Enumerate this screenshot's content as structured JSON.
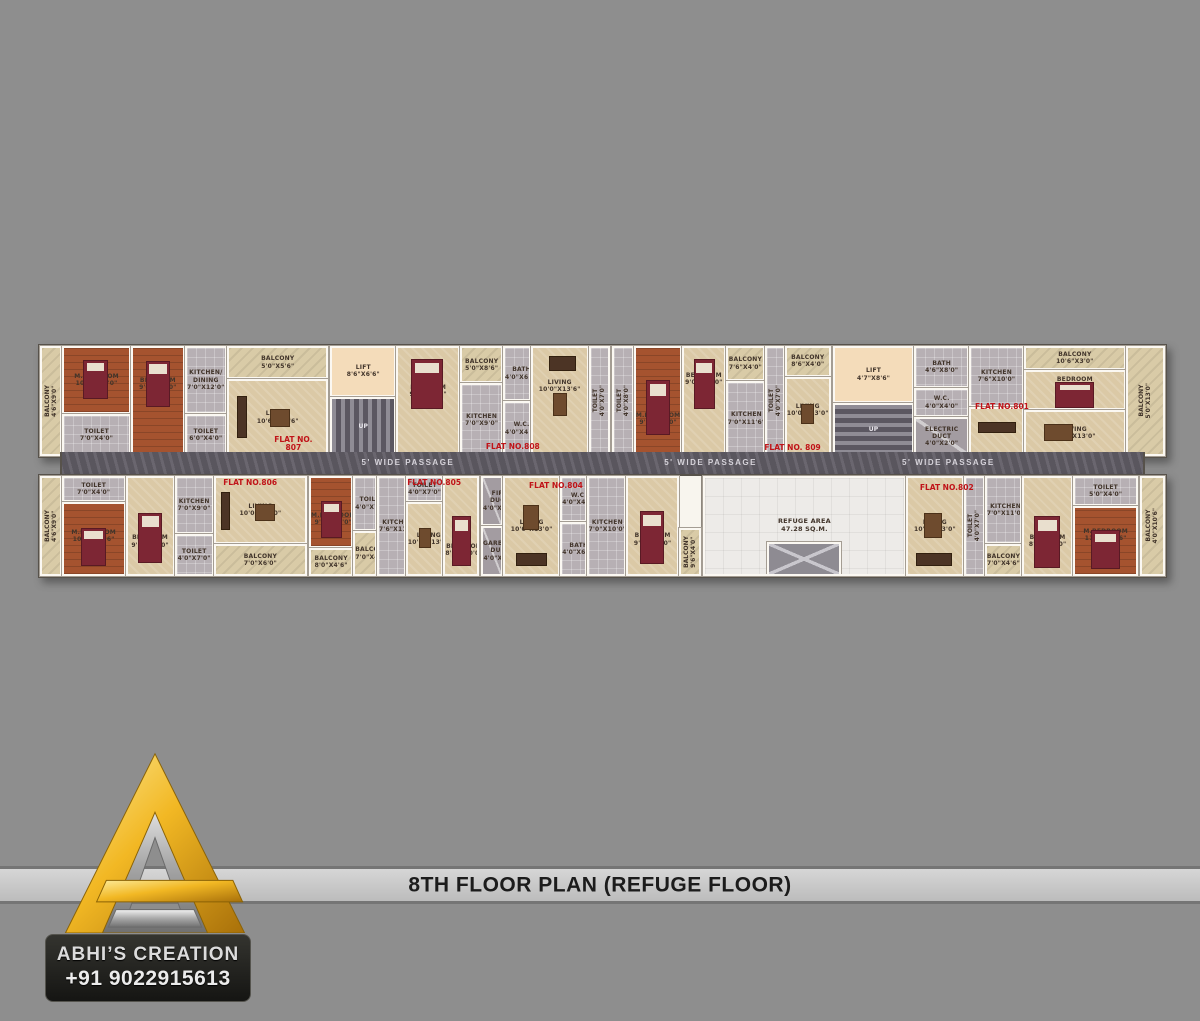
{
  "title_bar": {
    "title": "8TH FLOOR PLAN (REFUGE FLOOR)"
  },
  "brand": {
    "name": "ABHI’S CREATION",
    "phone": "+91 9022915613",
    "logo": "gold-silver-A-triangle",
    "colors": {
      "gold": "#f2b824",
      "silver": "#c9c9c9",
      "box_bg": "#1d1d1b"
    }
  },
  "colors": {
    "background": "#8e8e8e",
    "flat_number_red": "#c01318",
    "passage_marble": "#615d66",
    "floor_beige": "#dbc9a6",
    "floor_wood": "#a5532f",
    "refuge_white": "#edebe8"
  },
  "plan": {
    "passages": [
      "5' WIDE PASSAGE",
      "5' WIDE PASSAGE",
      "5' WIDE PASSAGE"
    ],
    "refuge": {
      "label": "REFUGE AREA\n47.28 SQ.M."
    },
    "cores": {
      "lift1": "LIFT\n8'6\"X6'6\"",
      "up1": "UP",
      "lift2": "LIFT\n4'7\"X8'6\"",
      "up2": "UP",
      "bath": "BATH\n4'6\"X8'0\"",
      "wc": "W.C.\n4'0\"X4'0\"",
      "electric_duct": "ELECTRIC DUCT\n4'0\"X2'0\""
    },
    "flats": {
      "f807": {
        "number": "FLAT NO.\n807",
        "balcony_left": "BALCONY\n4'6\"X9'0\"",
        "mbedroom": "M.BEDROOM\n10'6\"X12'0\"",
        "toilet1": "TOILET\n7'0\"X4'0\"",
        "bedroom": "BEDROOM\n9'0\"X11'0\"",
        "kitchen": "KITCHEN/\nDINING\n7'0\"X12'0\"",
        "toilet2": "TOILET\n6'0\"X4'0\"",
        "balcony_top": "BALCONY\n5'0\"X5'6\"",
        "living": "LIVING\n10'6\"X13'6\""
      },
      "f808": {
        "number": "FLAT NO.808",
        "bedroom": "BEDROOM\n9'6\"X12'0\"",
        "balcony": "BALCONY\n5'0\"X8'6\"",
        "kitchen": "KITCHEN\n7'0\"X9'0\"",
        "bath": "BATH\n4'0\"X6'0\"",
        "wc": "W.C.\n4'0\"X4'0\"",
        "living": "LIVING\n10'0\"X13'6\"",
        "toilet": "TOILET\n4'0\"X7'0\""
      },
      "f809": {
        "number": "FLAT NO. 809",
        "toilet1": "TOILET\n4'0\"X8'0\"",
        "mbedroom": "M.BEDROOM\n9'0\"X14'0\"",
        "bedroom": "BEDROOM\n9'0\"X12'0\"",
        "balcony1": "BALCONY\n7'6\"X4'0\"",
        "kitchen": "KITCHEN\n7'0\"X11'6\"",
        "toilet2": "TOILET\n4'0\"X7'0\"",
        "living": "LIVING\n10'0\"X13'0\"",
        "balcony2": "BALCONY\n8'6\"X4'0\""
      },
      "f801": {
        "number": "FLAT NO.801",
        "kitchen": "KITCHEN\n7'6\"X10'0\"",
        "balcony_top": "BALCONY\n10'6\"X3'0\"",
        "bedroom": "BEDROOM\n10'6\"X8'0\"",
        "living": "LIVING\n14'0\"X13'0\"",
        "balcony_right": "BALCONY\n5'0\"X13'0\""
      },
      "f806": {
        "number": "FLAT NO.806",
        "balcony_left": "BALCONY\n4'6\"X9'0\"",
        "toilet1": "TOILET\n7'0\"X4'0\"",
        "mbedroom": "M.BEDROOM\n10'6\"X13'6\"",
        "bedroom": "BEDROOM\n9'0\"X11'0\"",
        "kitchen": "KITCHEN\n7'0\"X9'0\"",
        "toilet2": "TOILET\n4'0\"X7'0\"",
        "living": "LIVING\n10'0\"X13'0\"",
        "balcony": "BALCONY\n7'0\"X6'0\""
      },
      "f805": {
        "number": "FLAT NO.805",
        "mbedroom": "M.BEDROOM\n9'0\"X11'0\"",
        "balcony1": "BALCONY\n8'0\"X4'6\"",
        "toilet1": "TOILET\n4'0\"X7'0\"",
        "balcony2": "BALCONY\n7'0\"X4'6\"",
        "kitchen": "KITCHEN\n7'6\"X11'6\"",
        "toilet2": "TOILET\n4'0\"X7'0\"",
        "living": "LIVING\n10'0\"X13'0\"",
        "bedroom": "BEDROOM\n8'0\"X10'0\""
      },
      "f804": {
        "number": "FLAT NO.804",
        "fire_duct": "FIRE\nDUCT\n4'0\"X2'0\"",
        "garbage_duct": "GARBAGE\nDUCT\n4'0\"X2'0\"",
        "living": "LIVING\n10'0\"X13'0\"",
        "wc": "W.C.\n4'0\"X4'0\"",
        "bath": "BATH\n4'0\"X6'0\"",
        "kitchen": "KITCHEN\n7'0\"X10'0\"",
        "bedroom": "BEDROOM\n9'0\"X12'0\"",
        "balcony": "BALCONY\n9'6\"X4'0\""
      },
      "f802": {
        "number": "FLAT NO.802",
        "living": "LIVING\n10'0\"X13'0\"",
        "toilet1": "TOILET\n4'0\"X7'0\"",
        "kitchen": "KITCHEN\n7'0\"X11'0\"",
        "balcony1": "BALCONY\n7'0\"X4'6\"",
        "bedroom": "BEDROOM\n8'0\"X10'0\"",
        "toilet2": "TOILET\n5'0\"X4'0\"",
        "mbedroom": "M.BEDROOM\n11'0\"X10'6\"",
        "balcony_right": "BALCONY\n4'0\"X10'6\""
      }
    }
  }
}
